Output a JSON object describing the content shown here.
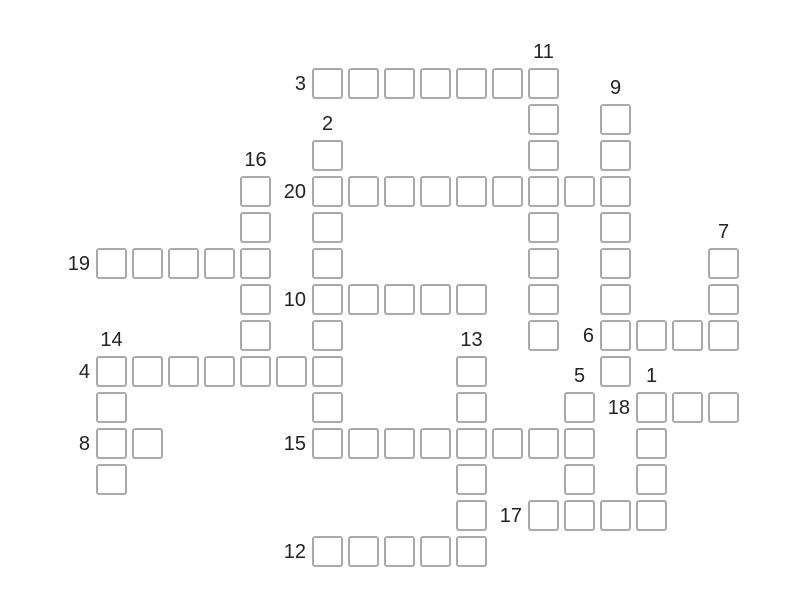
{
  "board": {
    "background": "#ffffff",
    "cell": {
      "size": 31,
      "pitch": 36,
      "origin_x": 96,
      "origin_y": 68,
      "border_color": "#a9a9a9",
      "border_width": 2,
      "corner_radius": 3,
      "fill": "#ffffff"
    },
    "label": {
      "color": "#222222",
      "font_size": 20,
      "across_gap": 6,
      "down_gap": 6
    },
    "words": [
      {
        "number": "1",
        "direction": "down",
        "col": 15,
        "row": 9,
        "length": 4
      },
      {
        "number": "2",
        "direction": "down",
        "col": 6,
        "row": 2,
        "length": 9
      },
      {
        "number": "3",
        "direction": "across",
        "col": 6,
        "row": 0,
        "length": 7
      },
      {
        "number": "4",
        "direction": "across",
        "col": 0,
        "row": 8,
        "length": 7
      },
      {
        "number": "5",
        "direction": "down",
        "col": 13,
        "row": 9,
        "length": 4
      },
      {
        "number": "6",
        "direction": "across",
        "col": 14,
        "row": 7,
        "length": 4
      },
      {
        "number": "7",
        "direction": "down",
        "col": 17,
        "row": 5,
        "length": 3
      },
      {
        "number": "8",
        "direction": "across",
        "col": 0,
        "row": 10,
        "length": 2
      },
      {
        "number": "9",
        "direction": "down",
        "col": 14,
        "row": 1,
        "length": 8
      },
      {
        "number": "10",
        "direction": "across",
        "col": 6,
        "row": 6,
        "length": 5
      },
      {
        "number": "11",
        "direction": "down",
        "col": 12,
        "row": 0,
        "length": 8
      },
      {
        "number": "12",
        "direction": "across",
        "col": 6,
        "row": 13,
        "length": 5
      },
      {
        "number": "13",
        "direction": "down",
        "col": 10,
        "row": 8,
        "length": 6
      },
      {
        "number": "14",
        "direction": "down",
        "col": 0,
        "row": 8,
        "length": 4
      },
      {
        "number": "15",
        "direction": "across",
        "col": 6,
        "row": 10,
        "length": 8
      },
      {
        "number": "16",
        "direction": "down",
        "col": 4,
        "row": 3,
        "length": 6
      },
      {
        "number": "17",
        "direction": "across",
        "col": 12,
        "row": 12,
        "length": 4
      },
      {
        "number": "18",
        "direction": "across",
        "col": 15,
        "row": 9,
        "length": 3
      },
      {
        "number": "19",
        "direction": "across",
        "col": 0,
        "row": 5,
        "length": 5
      },
      {
        "number": "20",
        "direction": "across",
        "col": 6,
        "row": 3,
        "length": 9
      }
    ]
  }
}
